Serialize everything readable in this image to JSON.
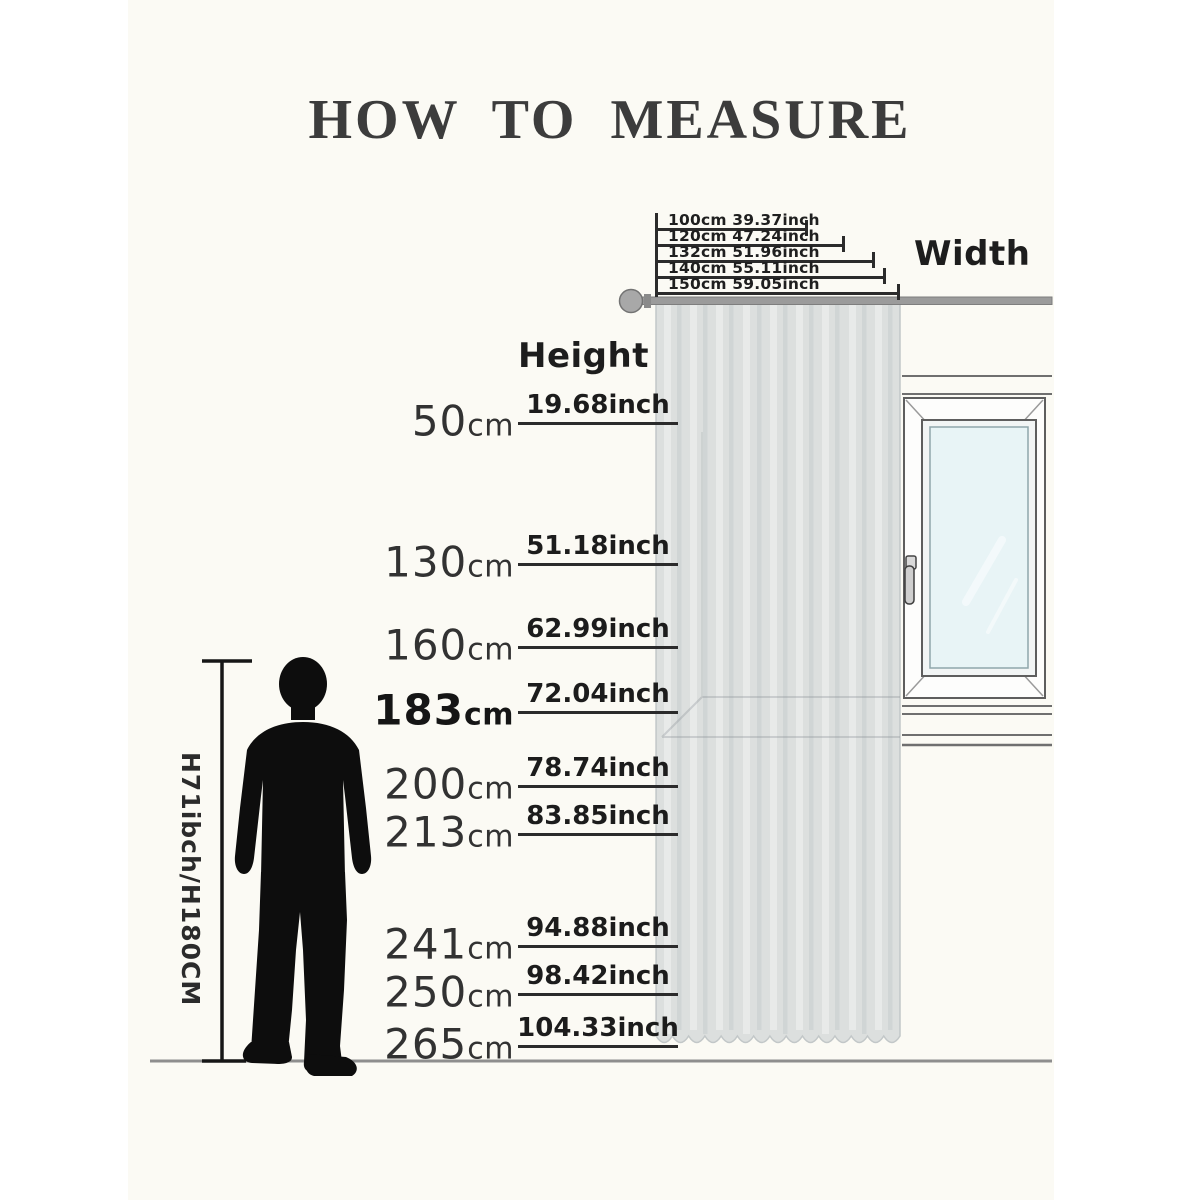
{
  "title": "HOW TO MEASURE",
  "axis_labels": {
    "width": "Width",
    "height": "Height"
  },
  "person": {
    "label": "H71ibch/H180CM"
  },
  "width_measurements": [
    {
      "label": "100cm 39.37inch",
      "cm": "100cm",
      "inch": "39.37inch",
      "line_y": 229,
      "tick_x": 806
    },
    {
      "label": "120cm 47.24inch",
      "cm": "120cm",
      "inch": "47.24inch",
      "line_y": 245,
      "tick_x": 843
    },
    {
      "label": "132cm 51.96inch",
      "cm": "132cm",
      "inch": "51.96inch",
      "line_y": 261,
      "tick_x": 873
    },
    {
      "label": "140cm 55.11inch",
      "cm": "140cm",
      "inch": "55.11inch",
      "line_y": 277,
      "tick_x": 884
    },
    {
      "label": "150cm 59.05inch",
      "cm": "150cm",
      "inch": "59.05inch",
      "line_y": 293,
      "tick_x": 898
    }
  ],
  "height_measurements": [
    {
      "value": "50",
      "unit": "cm",
      "inch": "19.68inch",
      "line_y": 423,
      "bold": false
    },
    {
      "value": "130",
      "unit": "cm",
      "inch": "51.18inch",
      "line_y": 564,
      "bold": false
    },
    {
      "value": "160",
      "unit": "cm",
      "inch": "62.99inch",
      "line_y": 647,
      "bold": false
    },
    {
      "value": "183",
      "unit": "cm",
      "inch": "72.04inch",
      "line_y": 712,
      "bold": true
    },
    {
      "value": "200",
      "unit": "cm",
      "inch": "78.74inch",
      "line_y": 786,
      "bold": false
    },
    {
      "value": "213",
      "unit": "cm",
      "inch": "83.85inch",
      "line_y": 834,
      "bold": false
    },
    {
      "value": "241",
      "unit": "cm",
      "inch": "94.88inch",
      "line_y": 946,
      "bold": false
    },
    {
      "value": "250",
      "unit": "cm",
      "inch": "98.42inch",
      "line_y": 994,
      "bold": false
    },
    {
      "value": "265",
      "unit": "cm",
      "inch": "104.33inch",
      "line_y": 1046,
      "bold": false
    }
  ],
  "colors": {
    "background": "#fbfaf4",
    "text": "#1f1f1f",
    "measure_line": "#2b2b2b",
    "curtain": "#dcdfde",
    "rod": "#9b9b9b",
    "window_glass": "#e8f4f6",
    "window_frame": "#5e5e5e",
    "floor_line": "#8e8e8e",
    "silhouette": "#0d0d0d"
  }
}
